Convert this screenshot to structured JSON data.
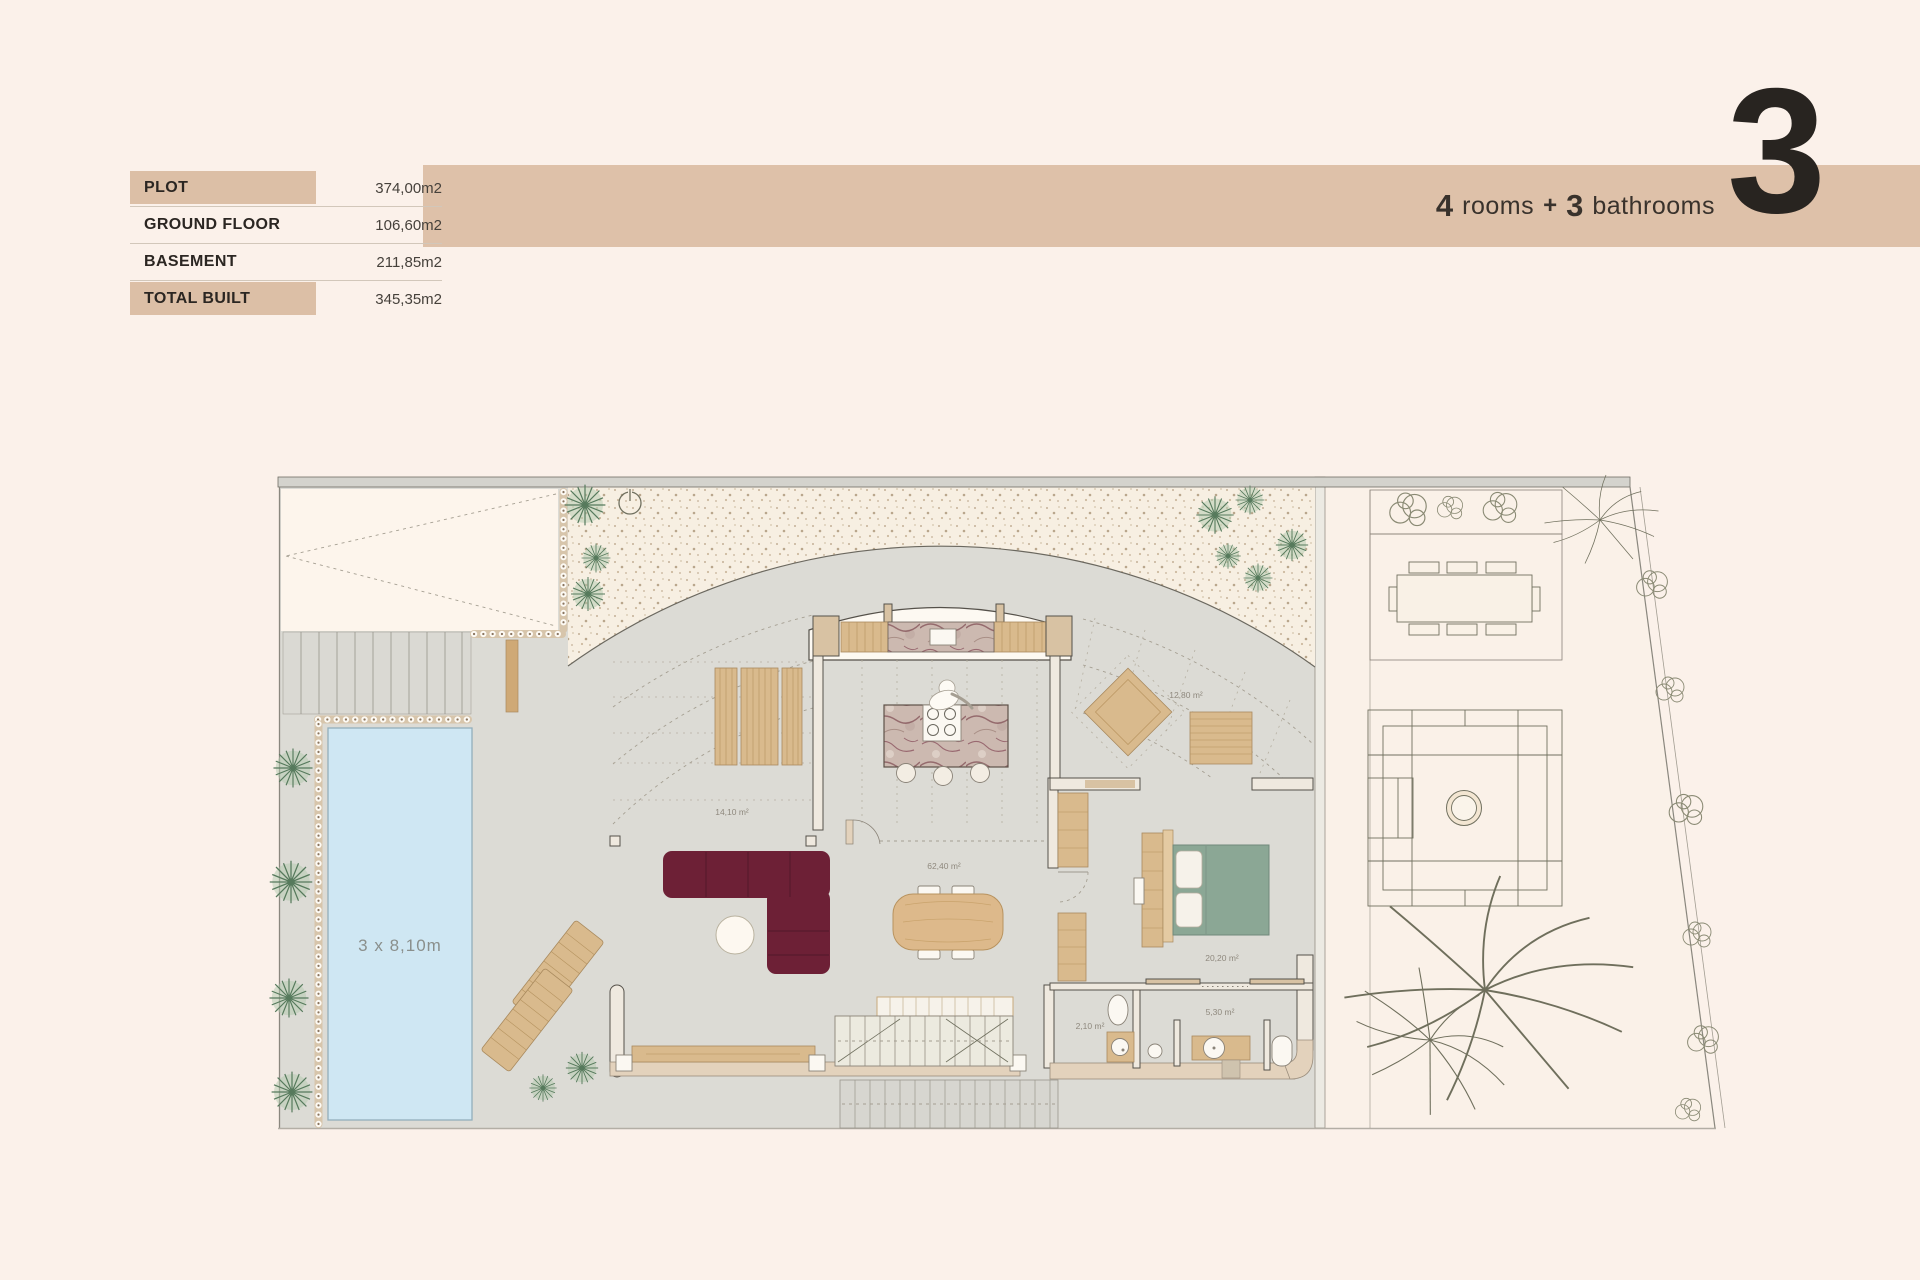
{
  "page": {
    "background": "#fbf1ea"
  },
  "header": {
    "floor_number": "3",
    "rooms_count": "4",
    "rooms_label": "rooms",
    "plus": "+",
    "bathrooms_count": "3",
    "bathrooms_label": "bathrooms",
    "banner_color": "#dec1a9"
  },
  "area_table": {
    "highlight_color": "#dcbfa6",
    "rows": [
      {
        "label": "PLOT",
        "value": "374,00m2",
        "highlighted": true
      },
      {
        "label": "GROUND FLOOR",
        "value": "106,60m2",
        "highlighted": false
      },
      {
        "label": "BASEMENT",
        "value": "211,85m2",
        "highlighted": false
      },
      {
        "label": "TOTAL BUILT",
        "value": "345,35m2",
        "highlighted": true
      }
    ]
  },
  "floor_plan": {
    "pool_label": "3 x 8,10m",
    "room_labels": [
      {
        "name": "covered-terrace",
        "text": "14,10 m²"
      },
      {
        "name": "living-dining-kitchen",
        "text": "62,40 m²"
      },
      {
        "name": "terrace",
        "text": "12,80 m²"
      },
      {
        "name": "bedroom",
        "text": "20,20 m²"
      },
      {
        "name": "bathroom",
        "text": "5,30 m²"
      },
      {
        "name": "toilet",
        "text": "2,10 m²"
      }
    ],
    "colors": {
      "pool": "#cfe7f3",
      "sofa": "#6d2036",
      "bed": "#8ba795",
      "wood": "#d9ba8d",
      "terrace": "#dcdbd5",
      "gravel": "#f7efe2",
      "wall": "#efe9df",
      "wall_tan": "#d8c2a3",
      "marble_vein": "#8c5560",
      "plant": "#567a5c",
      "garden": "#faf1e8"
    }
  }
}
